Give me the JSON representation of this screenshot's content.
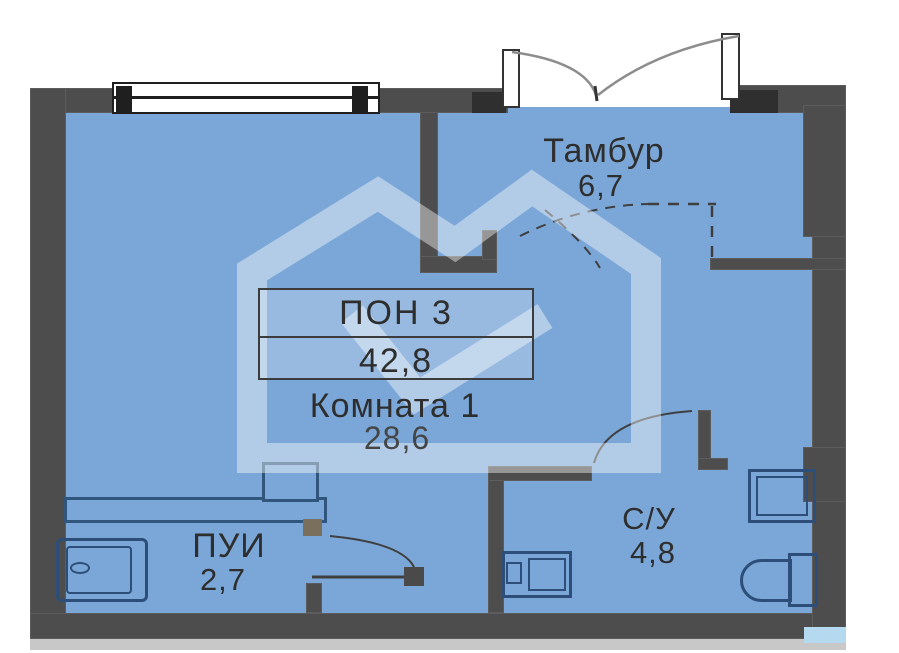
{
  "plan": {
    "unit": {
      "label": "ПОН 3",
      "total_area": "42,8"
    },
    "rooms": {
      "tambur": {
        "name": "Тамбур",
        "area": "6,7"
      },
      "komnata": {
        "name": "Комната 1",
        "area": "28,6"
      },
      "pui": {
        "name": "ПУИ",
        "area": "2,7"
      },
      "su": {
        "name": "С/У",
        "area": "4,8"
      }
    },
    "colors": {
      "floor": "#7ba7d8",
      "wall": "#4d4d4d",
      "fixture_outline": "#2c4e78",
      "text": "#2e2e2e",
      "watermark": "rgba(255,255,255,0.42)"
    }
  }
}
